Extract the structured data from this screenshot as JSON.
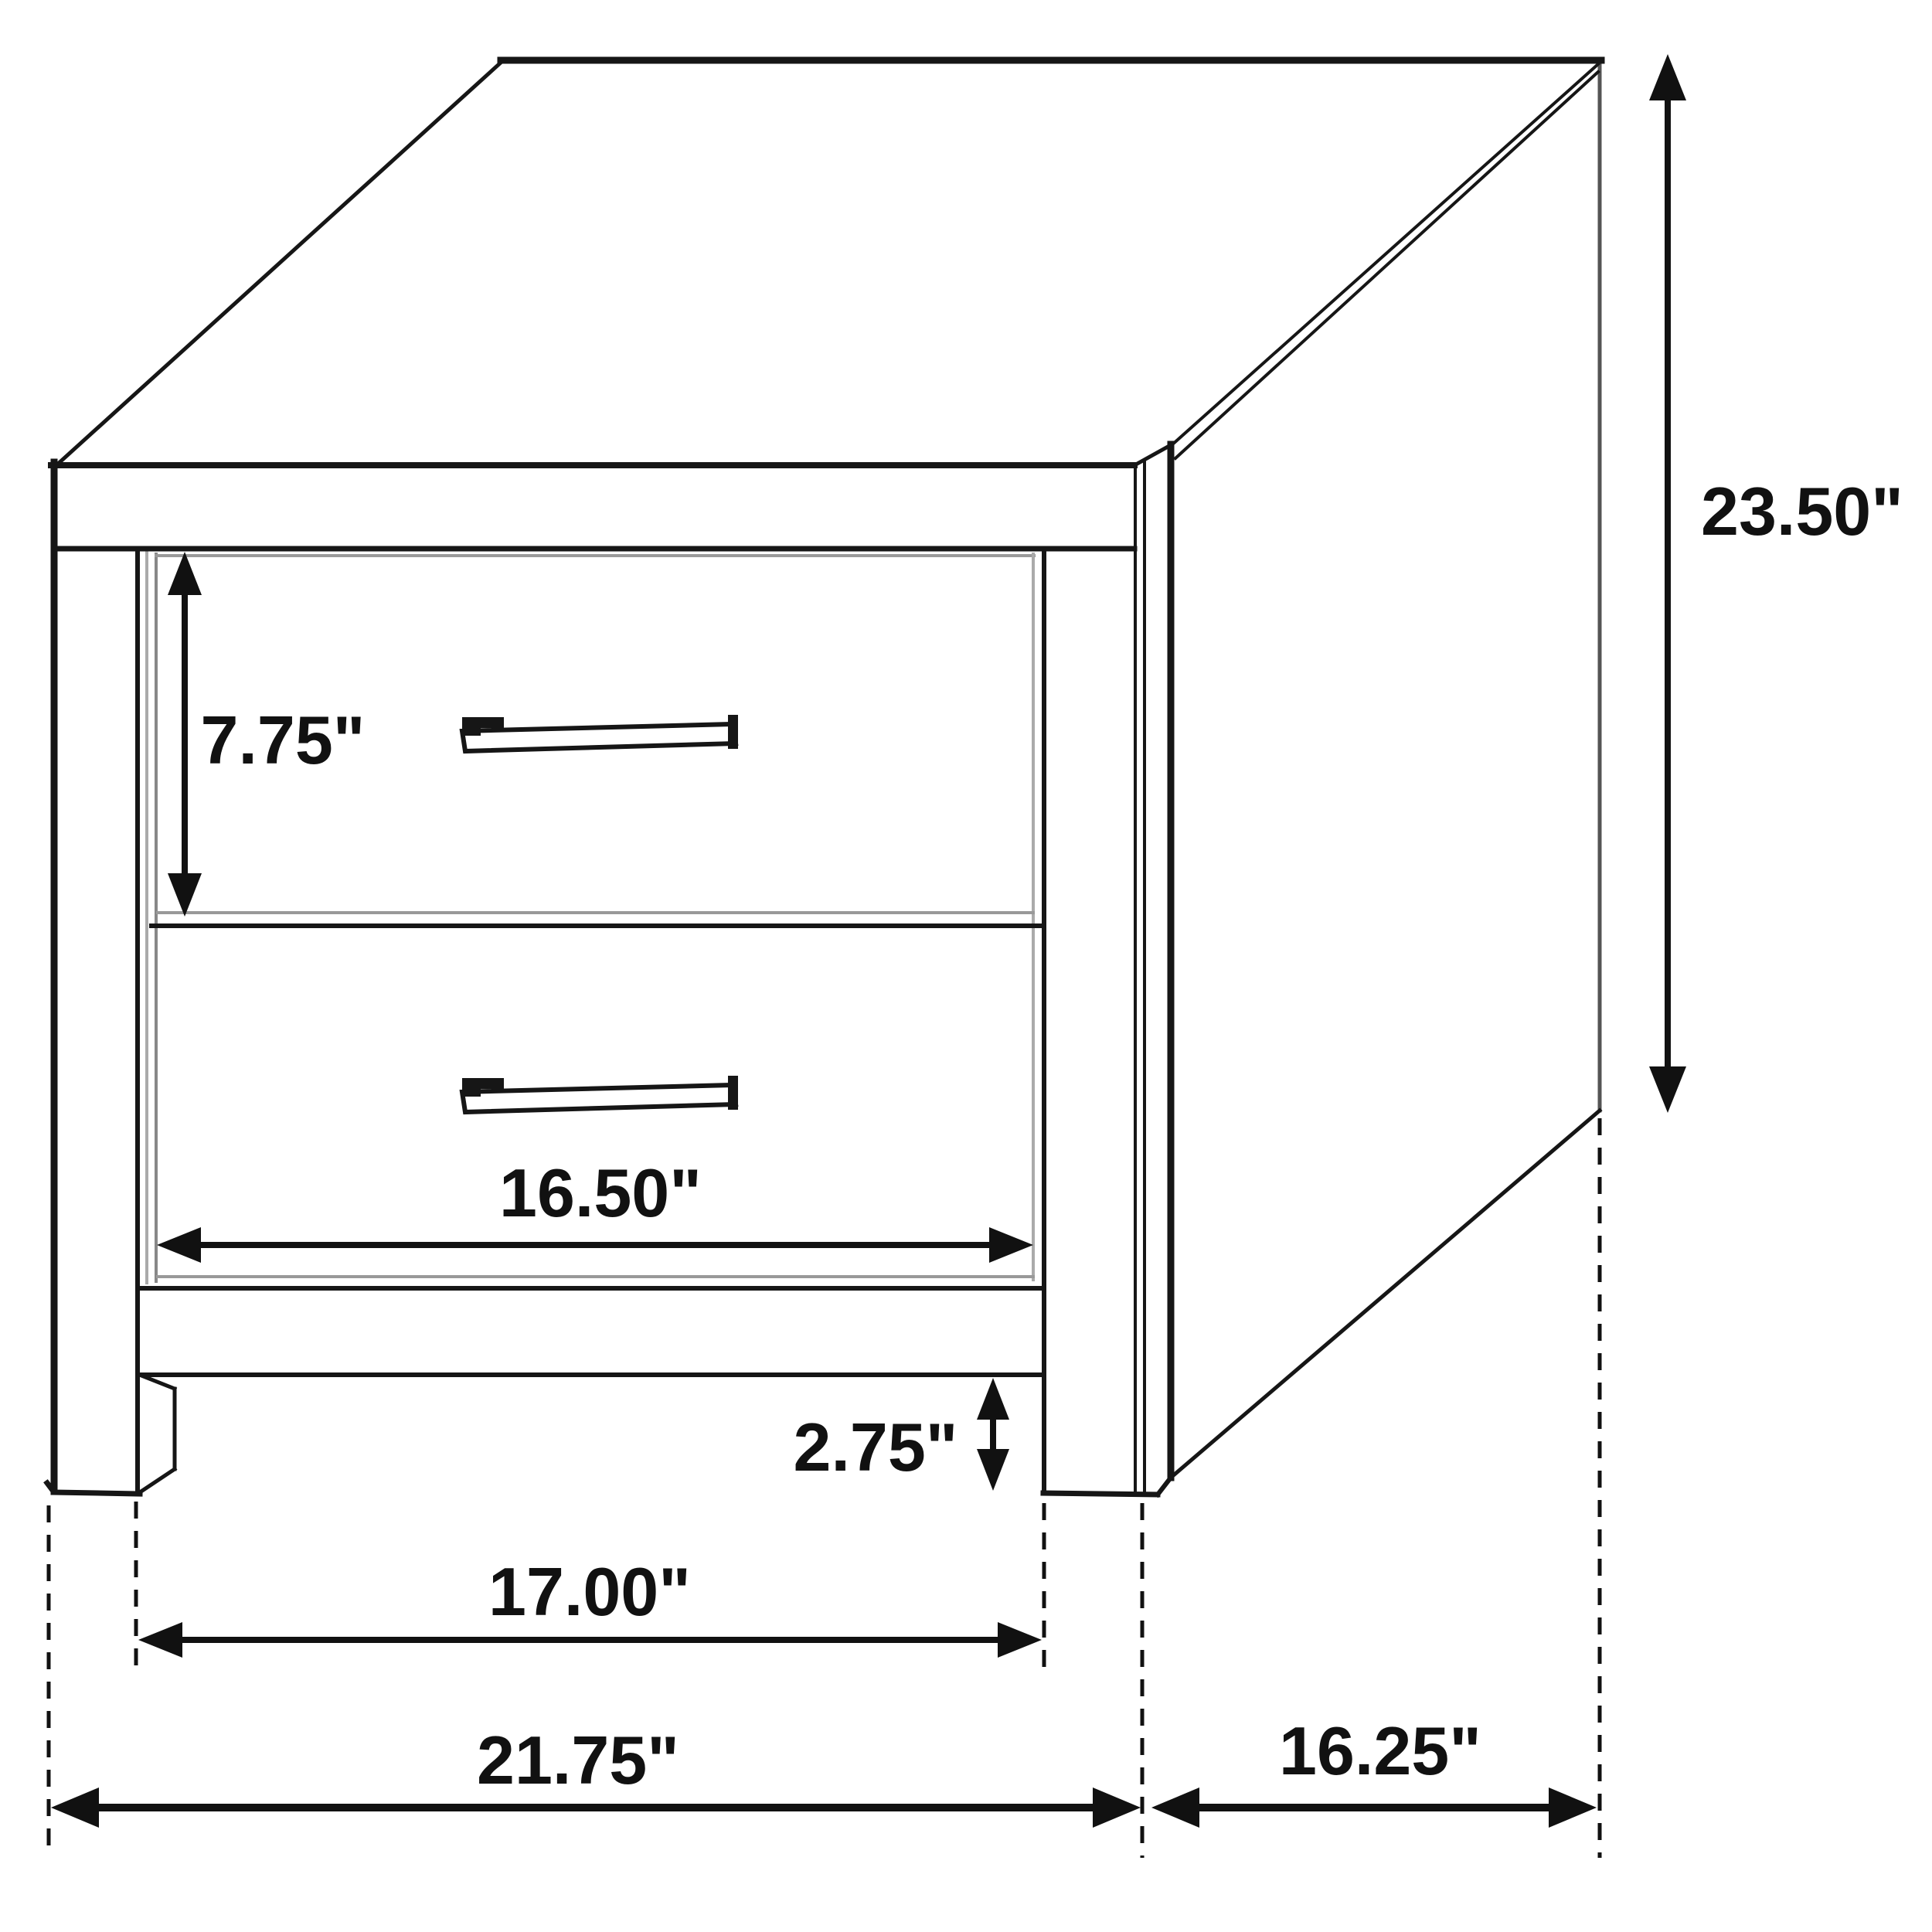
{
  "diagram": {
    "kind": "furniture-dimension-line-drawing",
    "subject": "two-drawer nightstand",
    "unit": "inches",
    "line_color": "#111111",
    "shadow_color": "#999999",
    "background_color": "#ffffff"
  },
  "dimensions": {
    "overall_height": {
      "value": 23.5,
      "label": "23.50\""
    },
    "drawer_front_height": {
      "value": 7.75,
      "label": "7.75\""
    },
    "drawer_front_width": {
      "value": 16.5,
      "label": "16.50\""
    },
    "leg_height": {
      "value": 2.75,
      "label": "2.75\""
    },
    "inner_width_between_legs": {
      "value": 17.0,
      "label": "17.00\""
    },
    "overall_width": {
      "value": 21.75,
      "label": "21.75\""
    },
    "overall_depth": {
      "value": 16.25,
      "label": "16.25\""
    }
  }
}
